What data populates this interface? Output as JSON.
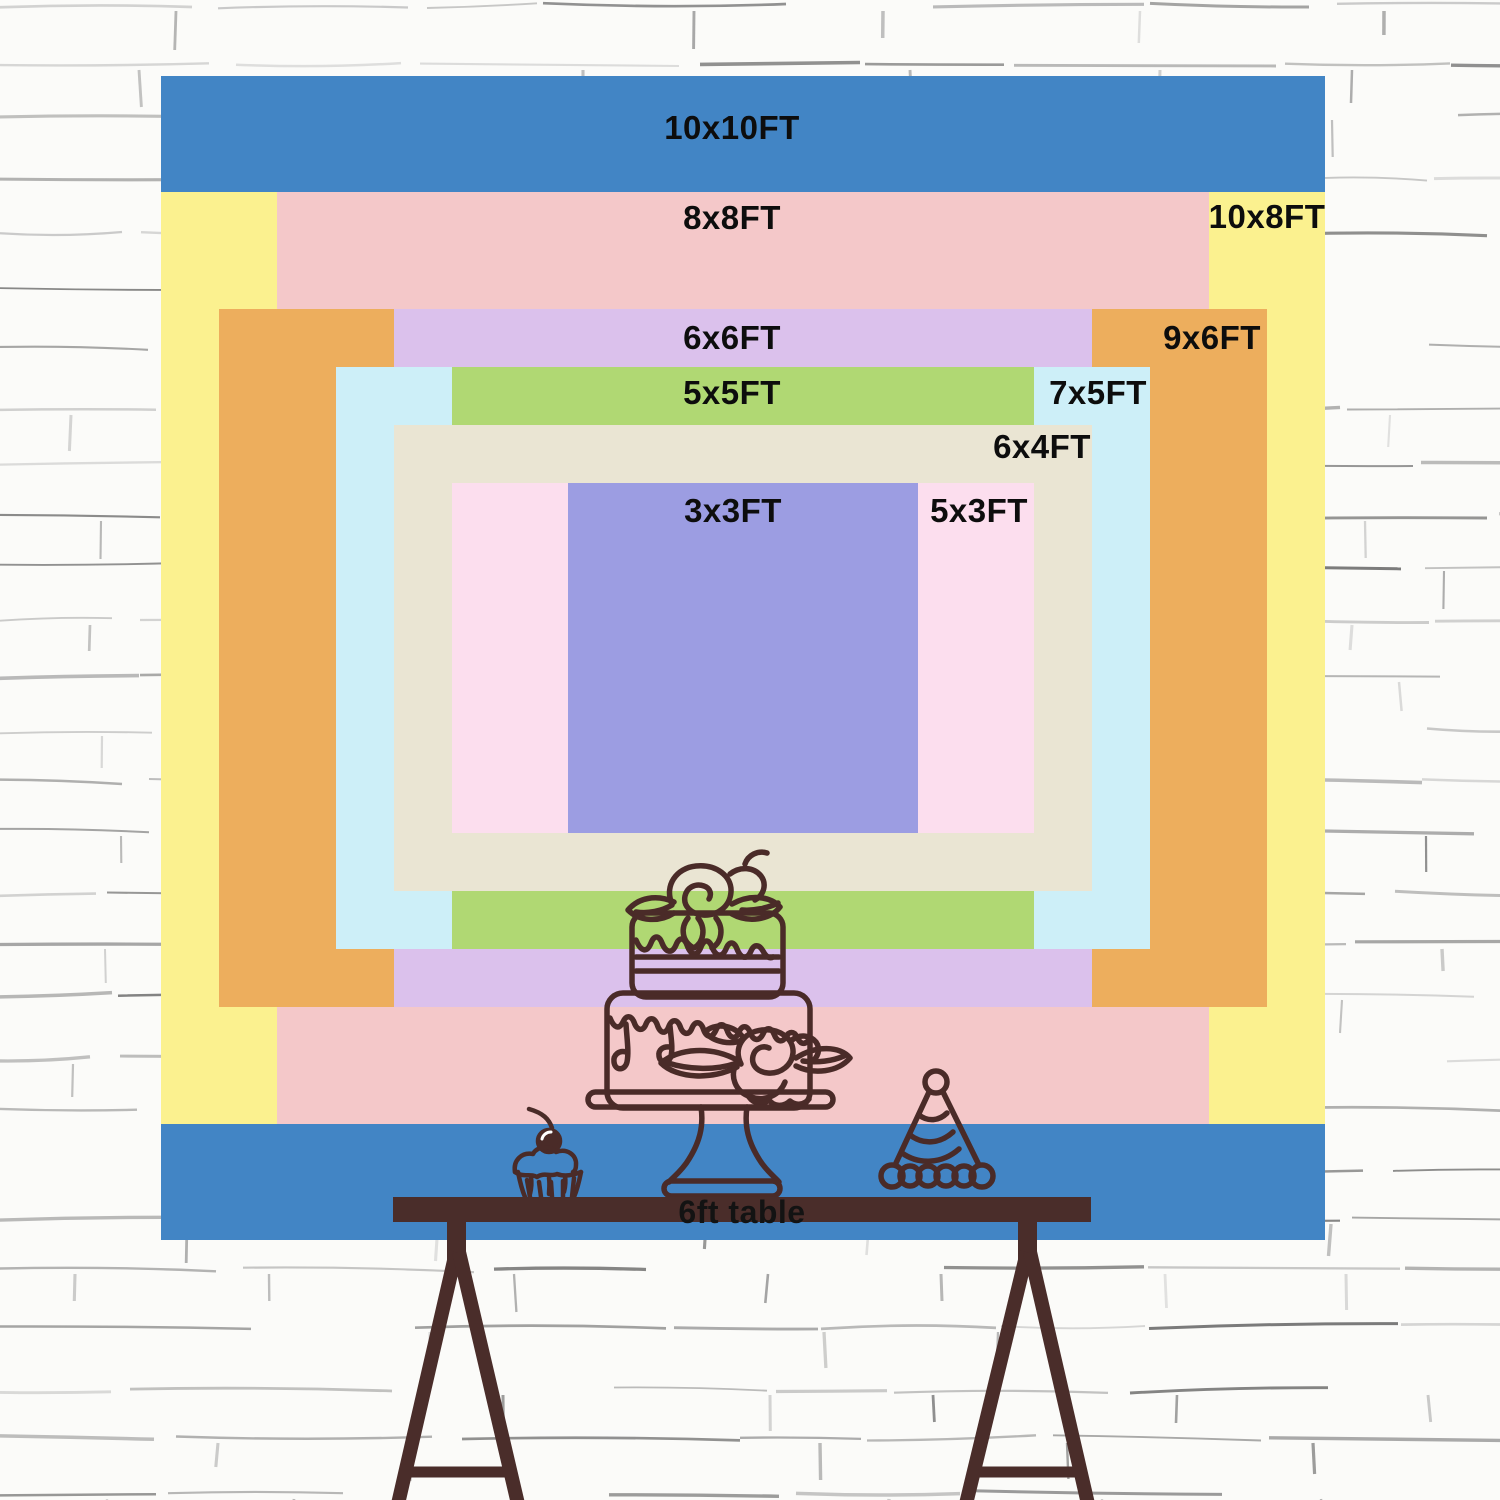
{
  "chart": {
    "type": "nested-backdrop-size-diagram",
    "unit": "FT",
    "sizes": [
      {
        "id": "10x10ft",
        "label": "10x10FT",
        "w_ft": 10,
        "h_ft": 10,
        "color": "#4285c5",
        "label_x": 732,
        "label_y": 128
      },
      {
        "id": "10x8ft",
        "label": "10x8FT",
        "w_ft": 10,
        "h_ft": 8,
        "color": "#fbf18f",
        "label_x": 1267,
        "label_y": 217
      },
      {
        "id": "8x8ft",
        "label": "8x8FT",
        "w_ft": 8,
        "h_ft": 8,
        "color": "#f4c8c9",
        "label_x": 732,
        "label_y": 218
      },
      {
        "id": "9x6ft",
        "label": "9x6FT",
        "w_ft": 9,
        "h_ft": 6,
        "color": "#edae5d",
        "label_x": 1212,
        "label_y": 338
      },
      {
        "id": "6x6ft",
        "label": "6x6FT",
        "w_ft": 6,
        "h_ft": 6,
        "color": "#dbc1ec",
        "label_x": 732,
        "label_y": 338
      },
      {
        "id": "7x5ft",
        "label": "7x5FT",
        "w_ft": 7,
        "h_ft": 5,
        "color": "#cdeff8",
        "label_x": 1098,
        "label_y": 393
      },
      {
        "id": "5x5ft",
        "label": "5x5FT",
        "w_ft": 5,
        "h_ft": 5,
        "color": "#b0d873",
        "label_x": 732,
        "label_y": 393
      },
      {
        "id": "6x4ft",
        "label": "6x4FT",
        "w_ft": 6,
        "h_ft": 4,
        "color": "#eae5d3",
        "label_x": 1042,
        "label_y": 447
      },
      {
        "id": "5x3ft",
        "label": "5x3FT",
        "w_ft": 5,
        "h_ft": 3,
        "color": "#fcdeee",
        "label_x": 979,
        "label_y": 511
      },
      {
        "id": "3x3ft",
        "label": "3x3FT",
        "w_ft": 3,
        "h_ft": 3,
        "color": "#9c9de2",
        "label_x": 733,
        "label_y": 511
      }
    ]
  },
  "table": {
    "label": "6ft table",
    "color": "#4a2d2a"
  },
  "artwork": {
    "outline_color": "#4a2b28",
    "items": [
      "cake-icon",
      "cupcake-icon",
      "party-hat-icon"
    ]
  },
  "wall": {
    "style": "white-brick-sketch",
    "line_color": "#8a8a8a",
    "background": "#fbfbf9"
  }
}
